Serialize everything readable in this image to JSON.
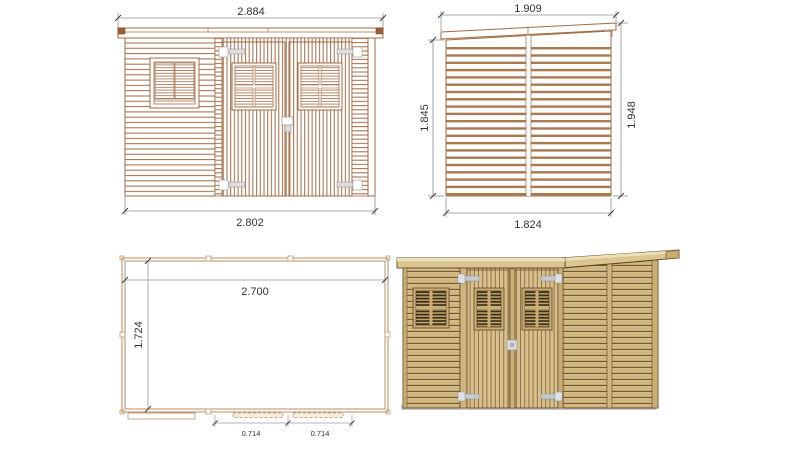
{
  "colors": {
    "background": "#ffffff",
    "drawing_line": "#a06a44",
    "dimension_line": "#8c8c8c",
    "dimension_text": "#333333",
    "plan_wall": "#b98e5f",
    "wood_light": "#d4bb84",
    "wood_gap": "#6e5433",
    "wood_trim": "#c9ad73",
    "window_dark": "#3f2e1a",
    "hinge_gray": "#c6cacd",
    "shadow_gray": "#c9c9c9"
  },
  "views": {
    "front_elevation": {
      "dims": {
        "roof_width": "2.884",
        "wall_width": "2.802"
      }
    },
    "side_elevation": {
      "dims": {
        "roof_depth": "1.909",
        "rear_height": "1.845",
        "front_height": "1.948",
        "wall_depth": "1.824"
      }
    },
    "floor_plan": {
      "dims": {
        "interior_width": "2.700",
        "interior_depth": "1.724",
        "door_opening_left": "0.714",
        "door_opening_right": "0.714"
      }
    }
  }
}
